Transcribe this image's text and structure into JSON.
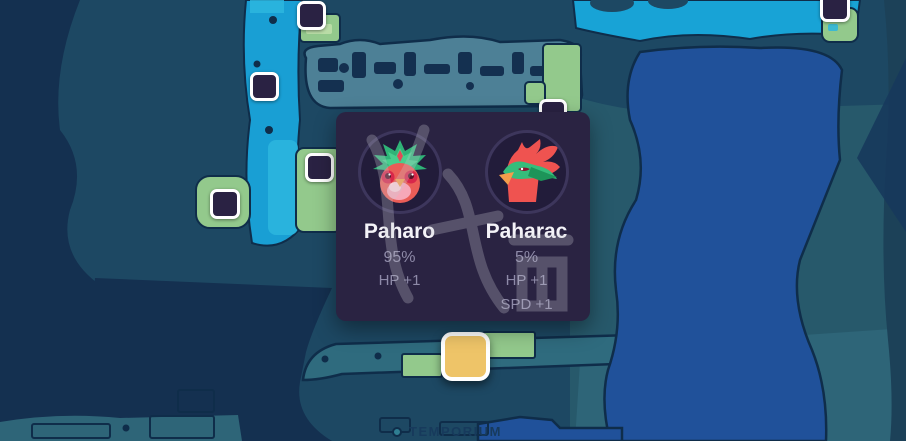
{
  "window": {
    "width": 906,
    "height": 441
  },
  "map": {
    "label": "TEMPORIUM",
    "colors": {
      "deep_land": "#143050",
      "mid_land": "#1d4863",
      "low_land": "#2e6578",
      "river": "#199fd4",
      "lake": "#20519a",
      "platform_green": "#93c98c",
      "ruins": "#4d8096",
      "outline": "#0f2d4a"
    },
    "markers": [
      {
        "id": "spawn-marker-1",
        "x": 297,
        "y": 1,
        "size": 23,
        "type": "spawn"
      },
      {
        "id": "spawn-marker-2",
        "x": 250,
        "y": 72,
        "size": 23,
        "type": "spawn"
      },
      {
        "id": "spawn-marker-3",
        "x": 305,
        "y": 153,
        "size": 23,
        "type": "spawn"
      },
      {
        "id": "spawn-marker-4",
        "x": 210,
        "y": 189,
        "size": 24,
        "type": "spawn"
      },
      {
        "id": "spawn-marker-5",
        "x": 539,
        "y": 99,
        "size": 22,
        "type": "spawn"
      },
      {
        "id": "spawn-marker-6",
        "x": 820,
        "y": -8,
        "size": 24,
        "type": "spawn"
      },
      {
        "id": "spawn-marker-selected",
        "x": 441,
        "y": 332,
        "size": 41,
        "type": "selected"
      }
    ]
  },
  "popup": {
    "entries": [
      {
        "name": "Paharo",
        "chance": "95%",
        "bonuses": [
          "HP +1"
        ]
      },
      {
        "name": "Paharac",
        "chance": "5%",
        "bonuses": [
          "HP +1",
          "SPD +1"
        ]
      }
    ]
  },
  "watermark": {
    "description": "semi-transparent calligraphy watermark",
    "opacity": 0.28
  },
  "theme": {
    "popup_bg": "#2a2342",
    "portrait_ring": "#3d365c",
    "name_color": "#f4f3f8",
    "sub_color": "#8e8aa8",
    "selected_marker": "#eec468",
    "marker_fill": "#2a2243",
    "marker_border": "#ffffff"
  }
}
